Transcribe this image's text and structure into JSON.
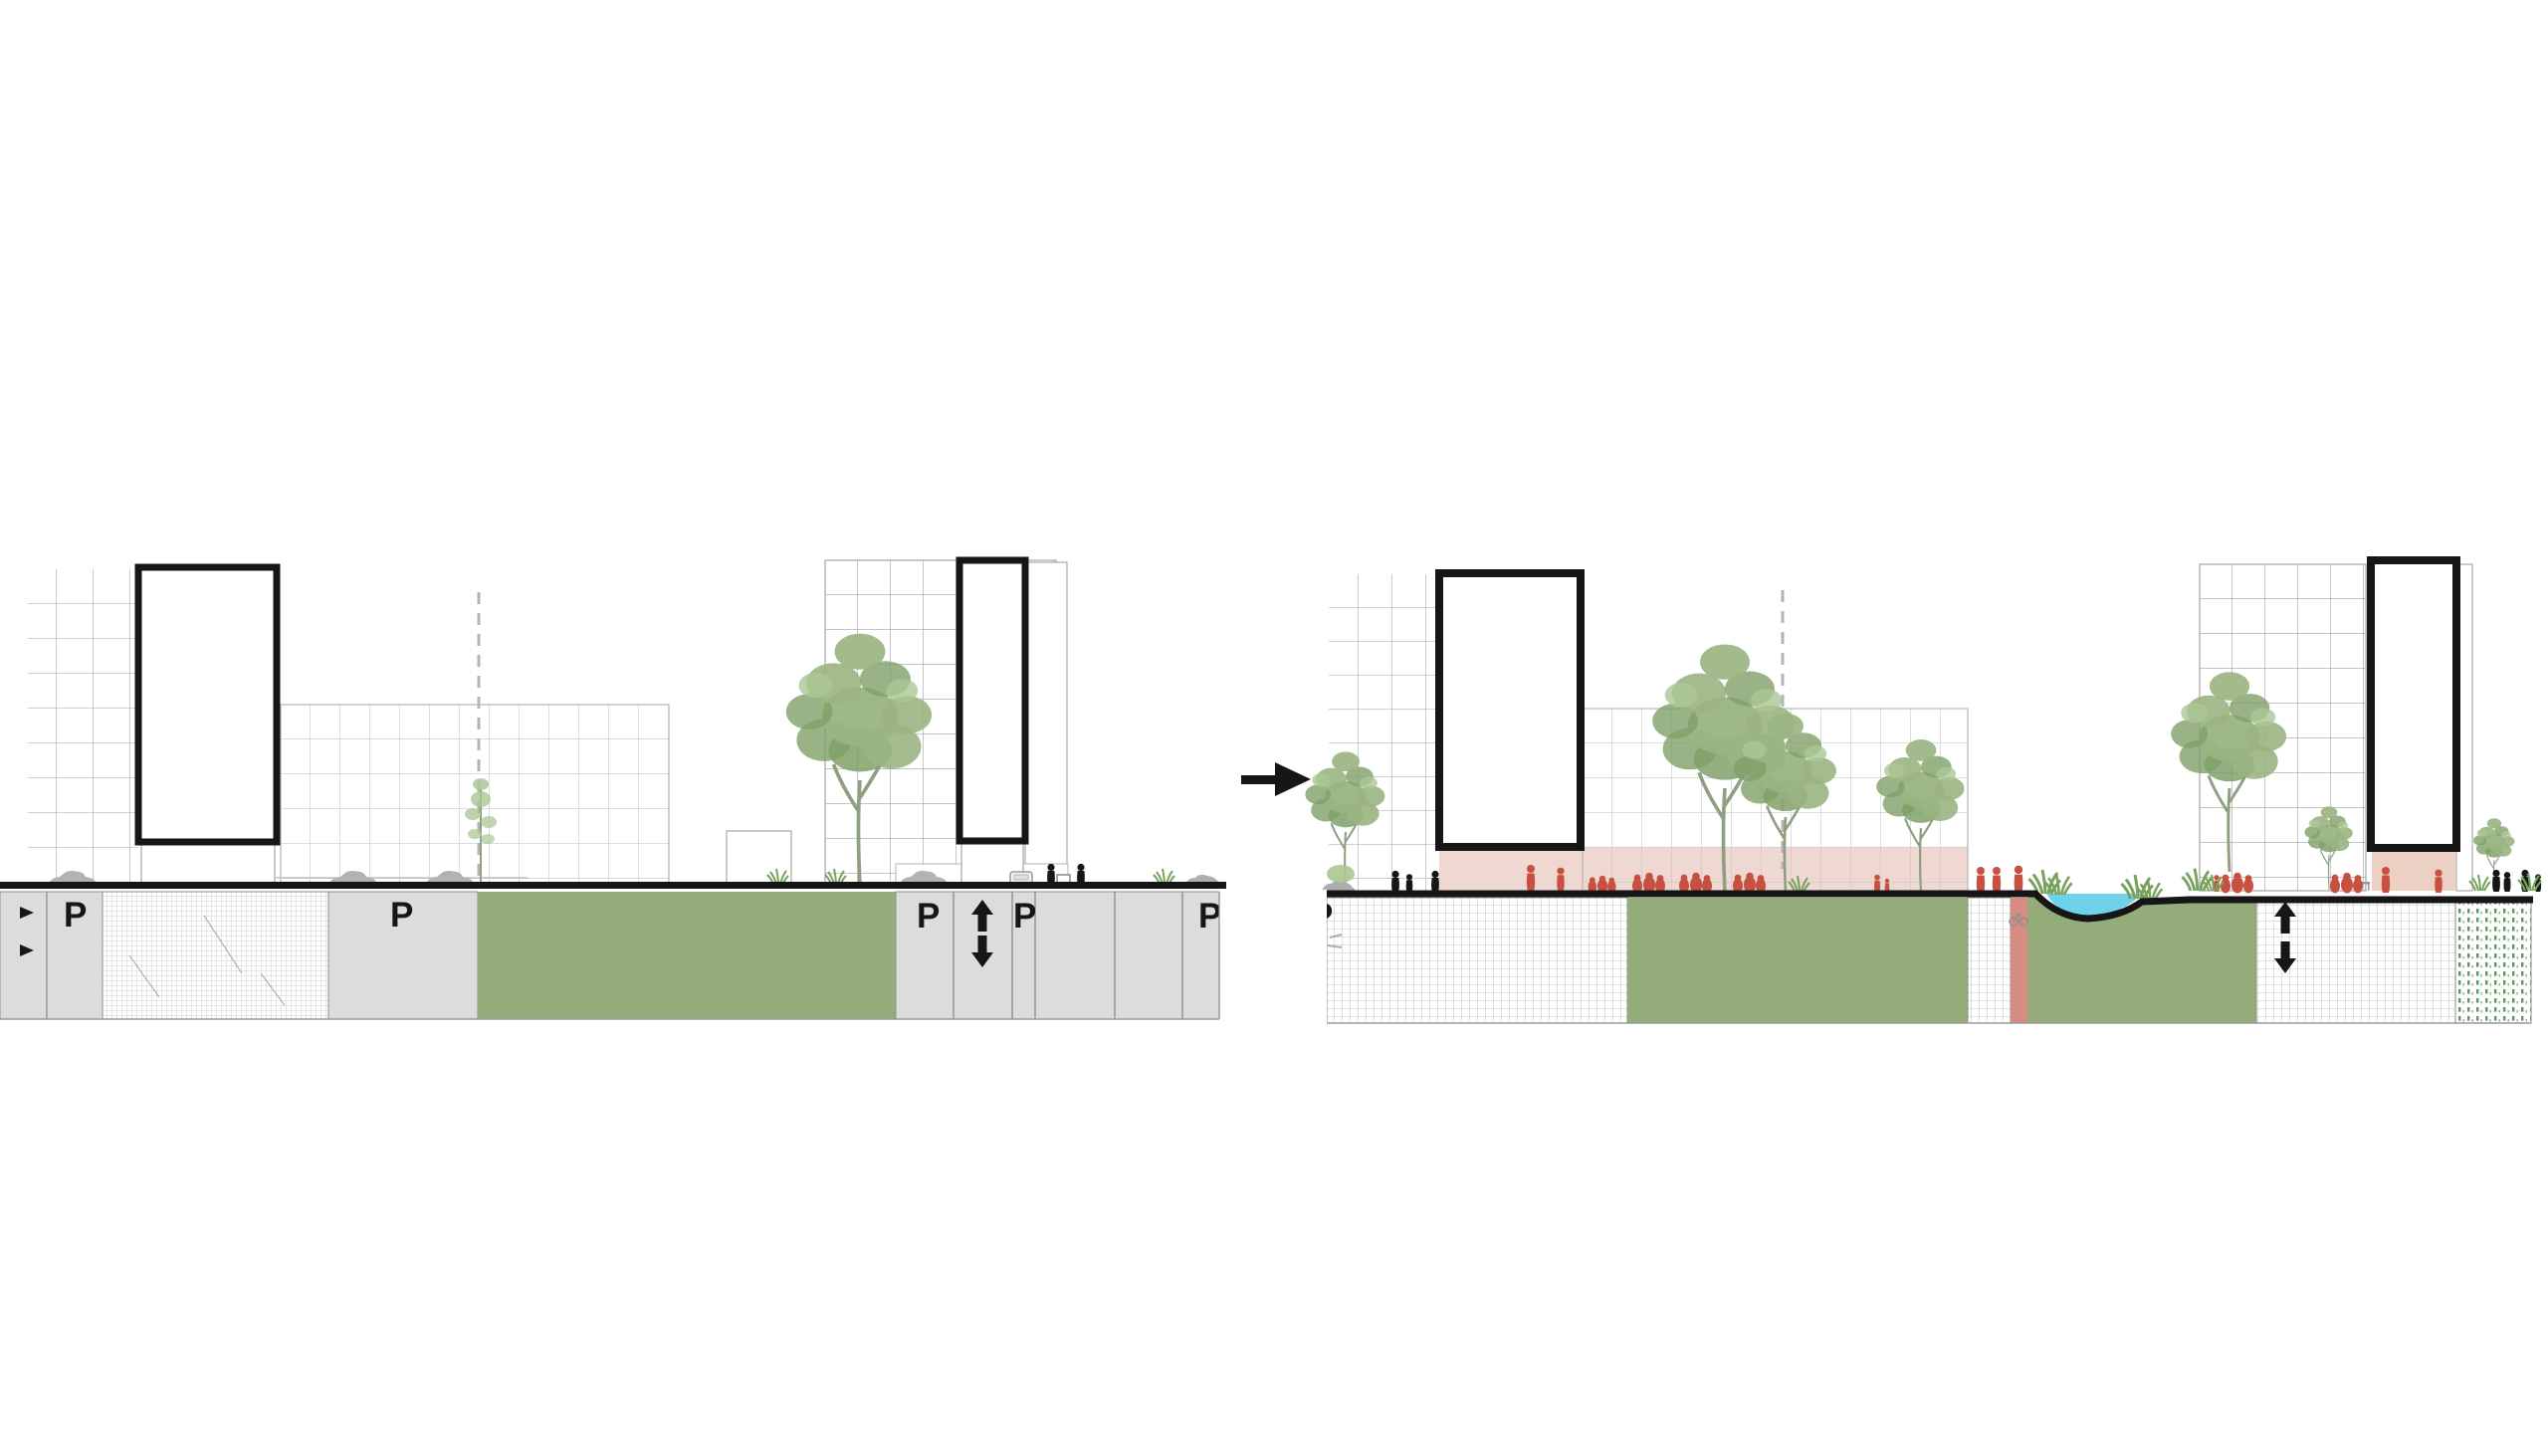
{
  "labels": {
    "parking": "P"
  },
  "icons": {
    "transform_arrow": "→",
    "ramp_up": "↑",
    "ramp_down": "↓"
  },
  "colors": {
    "ink": "#161616",
    "soil-green": "#93ac79",
    "soil-gray": "#dcdcdc",
    "soil-divider": "#8f8f8f",
    "hatch-line": "#c4c4c4",
    "grid-light": "#c7c7c7",
    "grid-med": "#a0a0a0",
    "outline-thin": "#ababab",
    "pink": "#eed8d1",
    "pink-dark": "#ecd0c4",
    "red-people": "#c85040",
    "red-column": "#d68c80",
    "water": "#6ed2e8",
    "tree": "#9ab482",
    "tree-dark": "#80a068",
    "tree-light": "#abc795",
    "trunk": "#8f9f82",
    "grass": "#76a25c",
    "car": "#b2b2b2",
    "mound": "#aeaeae",
    "dot-green": "#5a9b57"
  }
}
